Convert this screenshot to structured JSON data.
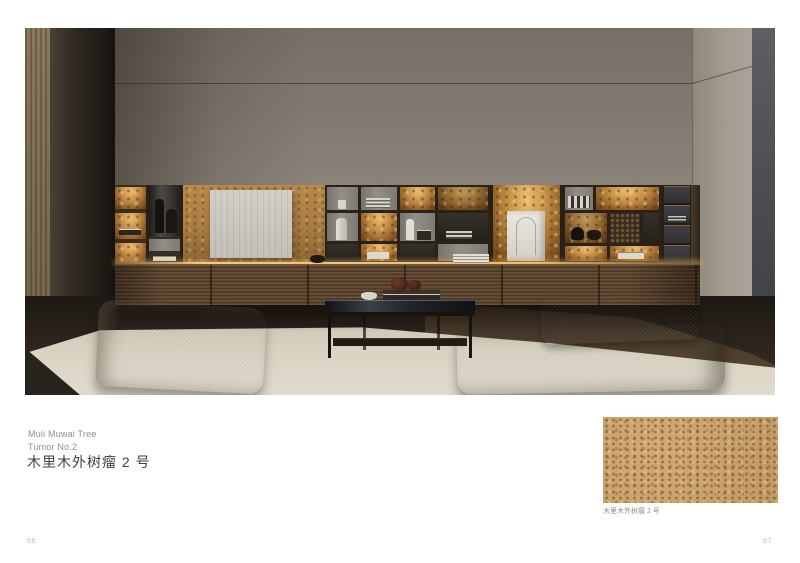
{
  "page": {
    "left_number": "06",
    "right_number": "07"
  },
  "product": {
    "title_en_line1": "Muli Muwai Tree",
    "title_en_line2": "Tumor No.2",
    "title_zh": "木里木外树瘤 2 号"
  },
  "swatch": {
    "caption": "木里木外树瘤 2 号",
    "material_color": "#c9a36c",
    "speckle_color": "#6b421c"
  },
  "scene": {
    "colors": {
      "wall": "#8d857a",
      "left_wood_panel": "#84725a",
      "dark_wardrobe_panel": "#2c2620",
      "right_gray_panel": "#4b4c51",
      "cabinet_walnut": "#5a4330",
      "backlight_amber": "#d9a85c",
      "burl_gold": "#b78a4c",
      "artwork_gray": "#cbc8c2",
      "rug": "#d9d3c4",
      "floor_wood": "#4a3b2c",
      "ottoman_light": "#c6c0b1",
      "ottoman_dark": "#85806f",
      "coffee_table": "#1a130d",
      "gourd_decor": "#552a1e"
    }
  }
}
